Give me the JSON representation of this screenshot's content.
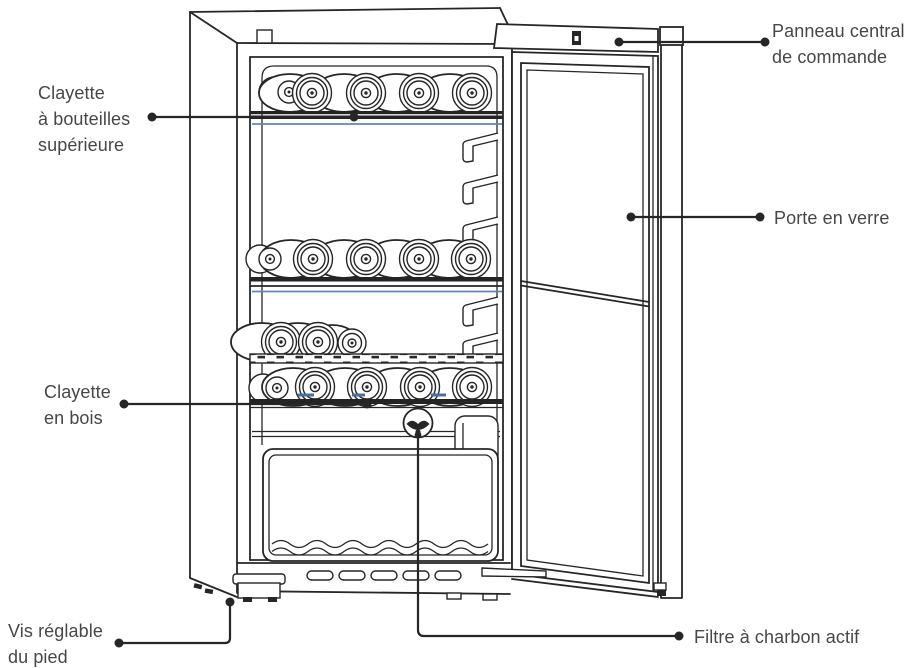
{
  "diagram": {
    "labels": {
      "upper_bottle_shelf": "Clayette\nà bouteilles\nsupérieure",
      "control_panel": "Panneau central\nde commande",
      "glass_door": "Porte en verre",
      "wooden_shelf": "Clayette\nen bois",
      "adjustable_foot_screw": "Vis réglable\ndu pied",
      "carbon_filter": "Filtre à charbon actif"
    },
    "colors": {
      "line": "#262626",
      "accent_blue": "#5f88ac",
      "label_text": "#474747",
      "background": "#ffffff"
    }
  }
}
